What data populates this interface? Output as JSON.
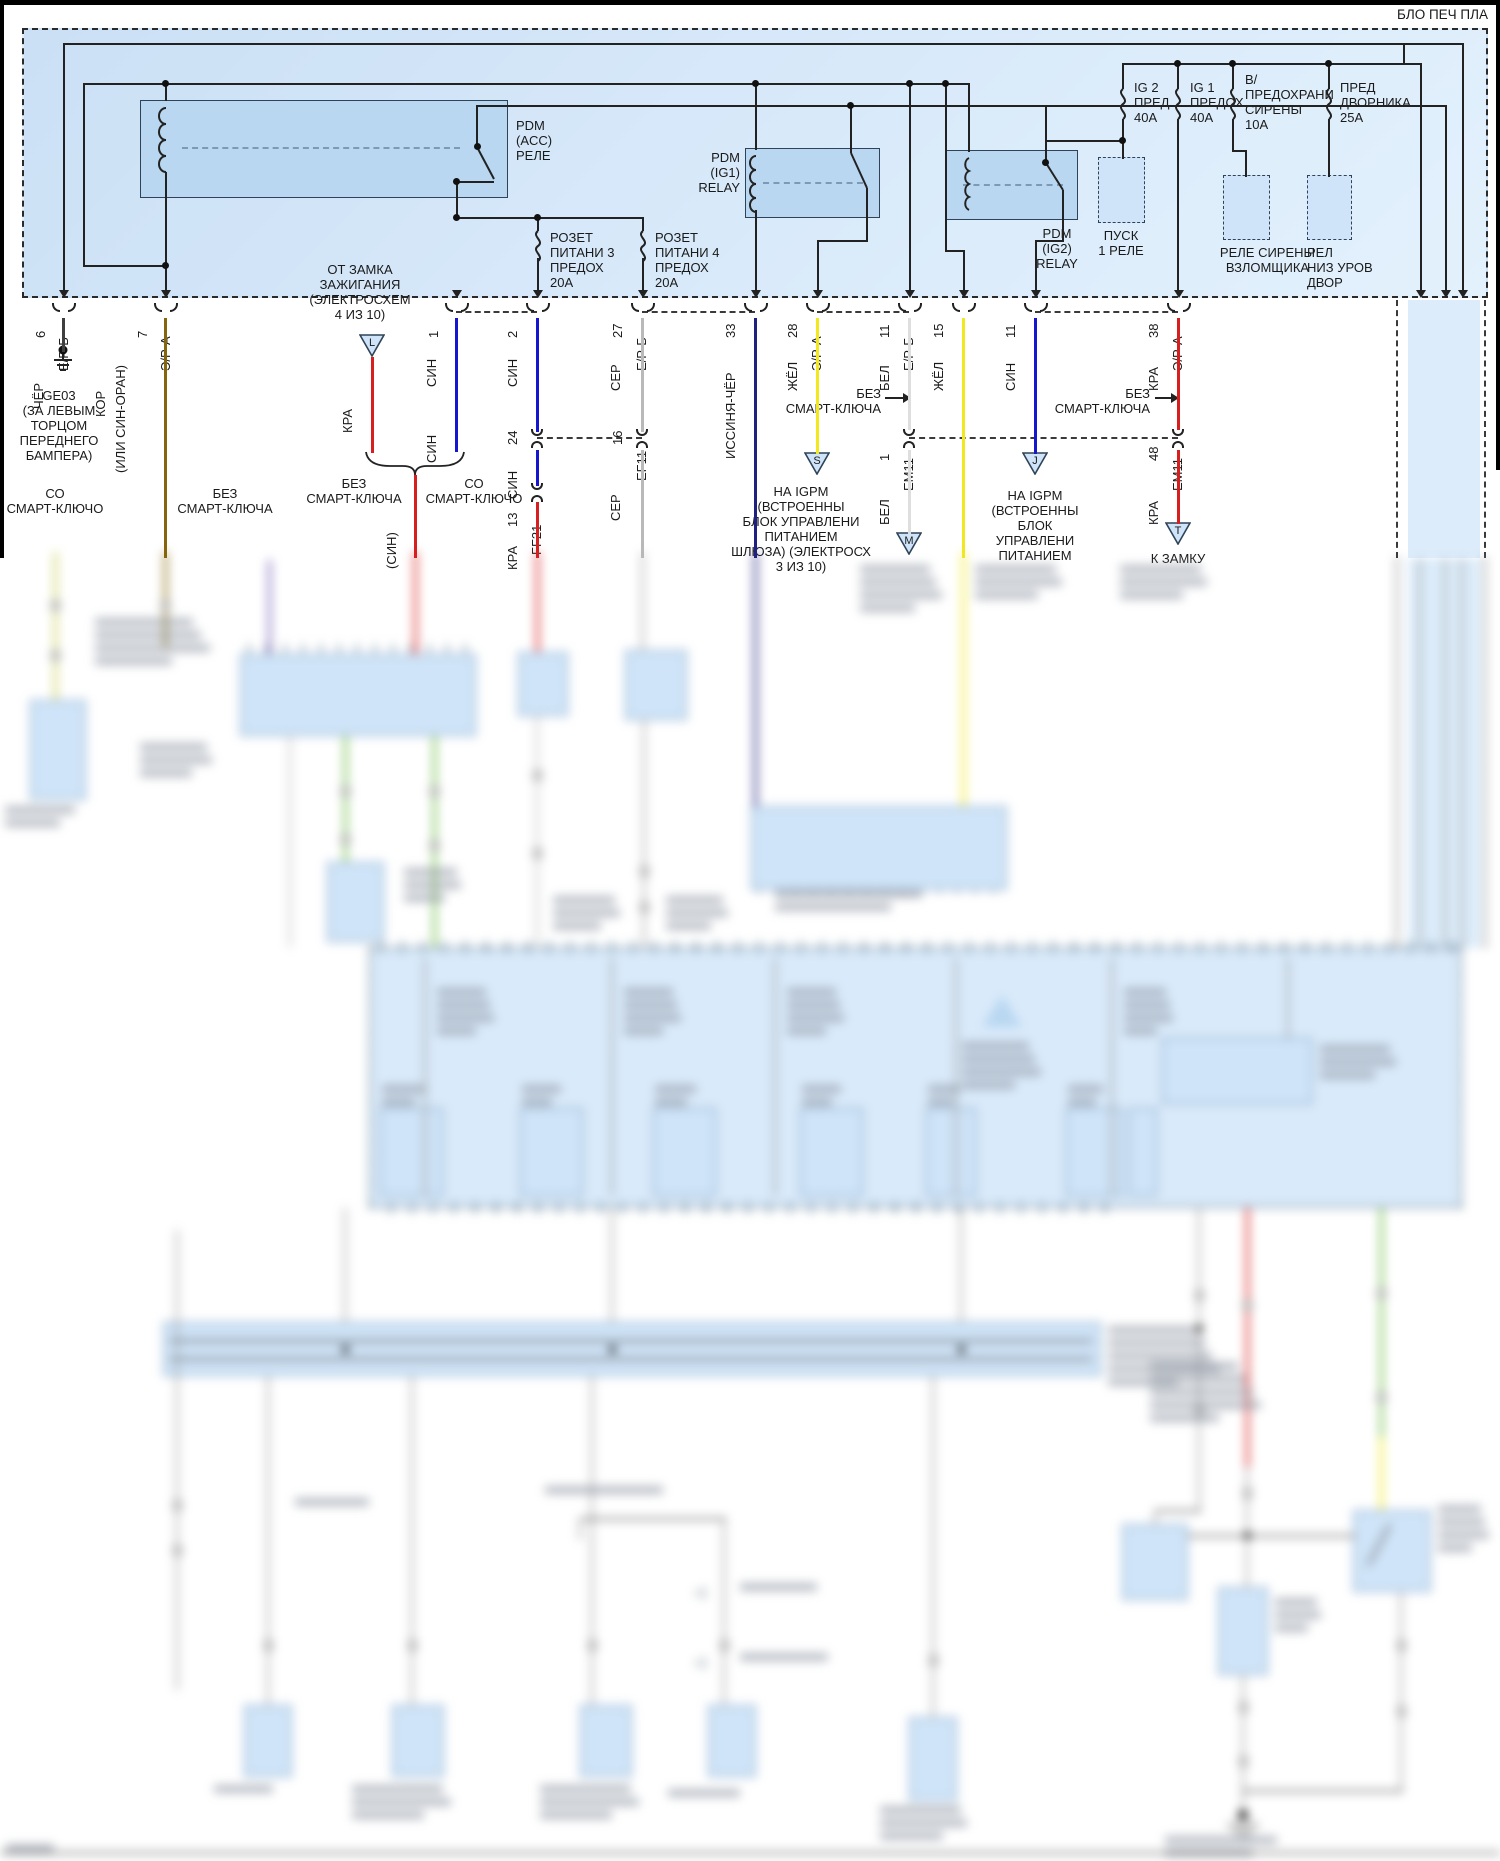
{
  "title": "БЛО ПЕЧ ПЛА",
  "palette": {
    "cher": "#3f3f3f",
    "kor": "#85660a",
    "kra": "#d81f1f",
    "sin": "#1616cf",
    "ser": "#b9b9b9",
    "zhel": "#f1e81f",
    "bel": "#dedede",
    "navy": "#20207f",
    "green": "#67b93e",
    "lime": "#c9cf5a",
    "violet": "#7a63b8",
    "gray2": "#9a9a9a",
    "panel_blue": "#d9eafa",
    "box_blue": "#b9d7f1"
  },
  "top": {
    "pdm_acc": "PDM\n(ACC)\nРЕЛЕ",
    "pdm_ig1": "PDM\n(IG1)\nRELAY",
    "pdm_ig2": "PDM\n(IG2)\nRELAY",
    "pusk_rele": "ПУСК\n1 РЕЛЕ",
    "rele_sireny": "РЕЛЕ СИРЕНЫ\nВЗЛОМЩИКА",
    "rel_dvor": "РЕЛ\nНИЗ УРОВ\nДВОР",
    "fuse_ig2": "IG 2\nПРЕД\n40A",
    "fuse_ig1": "IG 1\nПРЕДОХ\n40A",
    "fuse_siren": "В/\nПРЕДОХРАНИ\nСИРЕНЫ\n10A",
    "fuse_wiper": "ПРЕД\nДВОРНИКА\n25A",
    "fuse_rozet3": "РОЗЕТ\nПИТАНИ 3\nПРЕДОХ\n20A",
    "fuse_rozet4": "РОЗЕТ\nПИТАНИ 4\nПРЕДОХ\n20A"
  },
  "notes": {
    "ot_zamka": "ОТ ЗАМКА\nЗАЖИГАНИЯ\n(ЭЛЕКТРОСХЕМ\n4 ИЗ 10)",
    "ge03": "GE03\n(ЗА ЛЕВЫМ\nТОРЦОМ\nПЕРЕДНЕГО\nБАМПЕРА)",
    "so_smart_left": "СО\nСМАРТ-КЛЮЧО",
    "bez_smart_left": "БЕЗ\nСМАРТ-КЛЮЧА",
    "brace_bez": "БЕЗ\nСМАРТ-КЛЮЧА",
    "brace_so": "СО\nСМАРТ-КЛЮЧО",
    "sin_alt": "(СИН)",
    "bez_arrow_1": "БЕЗ\nСМАРТ-КЛЮЧА",
    "bez_arrow_2": "БЕЗ\nСМАРТ-КЛЮЧА",
    "igpm_s": "НА IGPM\n(ВСТРОЕННЫ\nБЛОК УПРАВЛЕНИ\nПИТАНИЕМ\nШЛЮЗА) (ЭЛЕКТРОСХ\n3 ИЗ 10)",
    "igpm_j": "НА IGPM\n(ВСТРОЕННЫ\nБЛОК\nУПРАВЛЕНИ\nПИТАНИЕМ",
    "k_zamku": "К ЗАМКУ"
  },
  "triangles": {
    "t1": "L",
    "t2": "S",
    "t3": "M",
    "t4": "J",
    "t5": "T"
  },
  "wires": [
    {
      "pin": "6",
      "conn": "Е/Р-Б",
      "color": "ЧЁР"
    },
    {
      "pin": "7",
      "conn": "Э/Р-А",
      "color": "КОР",
      "alt": "(ИЛИ СИН-ОРАН)"
    },
    {
      "color": "КРА"
    },
    {
      "pin": "1",
      "color": "СИН",
      "color2": "СИН"
    },
    {
      "pin": "2",
      "color": "СИН",
      "pin2": "24",
      "color2": "СИН",
      "pin3": "13",
      "conn2": "FF21",
      "color3": "КРА"
    },
    {
      "pin": "27",
      "conn": "Е/Р-Б",
      "color": "СЕР",
      "pin2": "16",
      "conn2": "EF11",
      "color2": "СЕР"
    },
    {
      "pin": "33",
      "color": "ИССИНЯ-ЧЁР"
    },
    {
      "pin": "28",
      "conn": "Э/Р-А",
      "color": "ЖЁЛ"
    },
    {
      "pin": "11",
      "conn": "Е/Р-Б",
      "color": "БЕЛ",
      "pin2": "1",
      "conn2": "ЕМ11",
      "color2": "БЕЛ"
    },
    {
      "pin": "15",
      "color": "ЖЁЛ"
    },
    {
      "pin": "11",
      "color": "СИН"
    },
    {
      "pin": "38",
      "conn": "Э/Р-А",
      "color": "КРА",
      "pin2": "48",
      "conn2": "ЕМ11",
      "color2": "КРА"
    }
  ]
}
